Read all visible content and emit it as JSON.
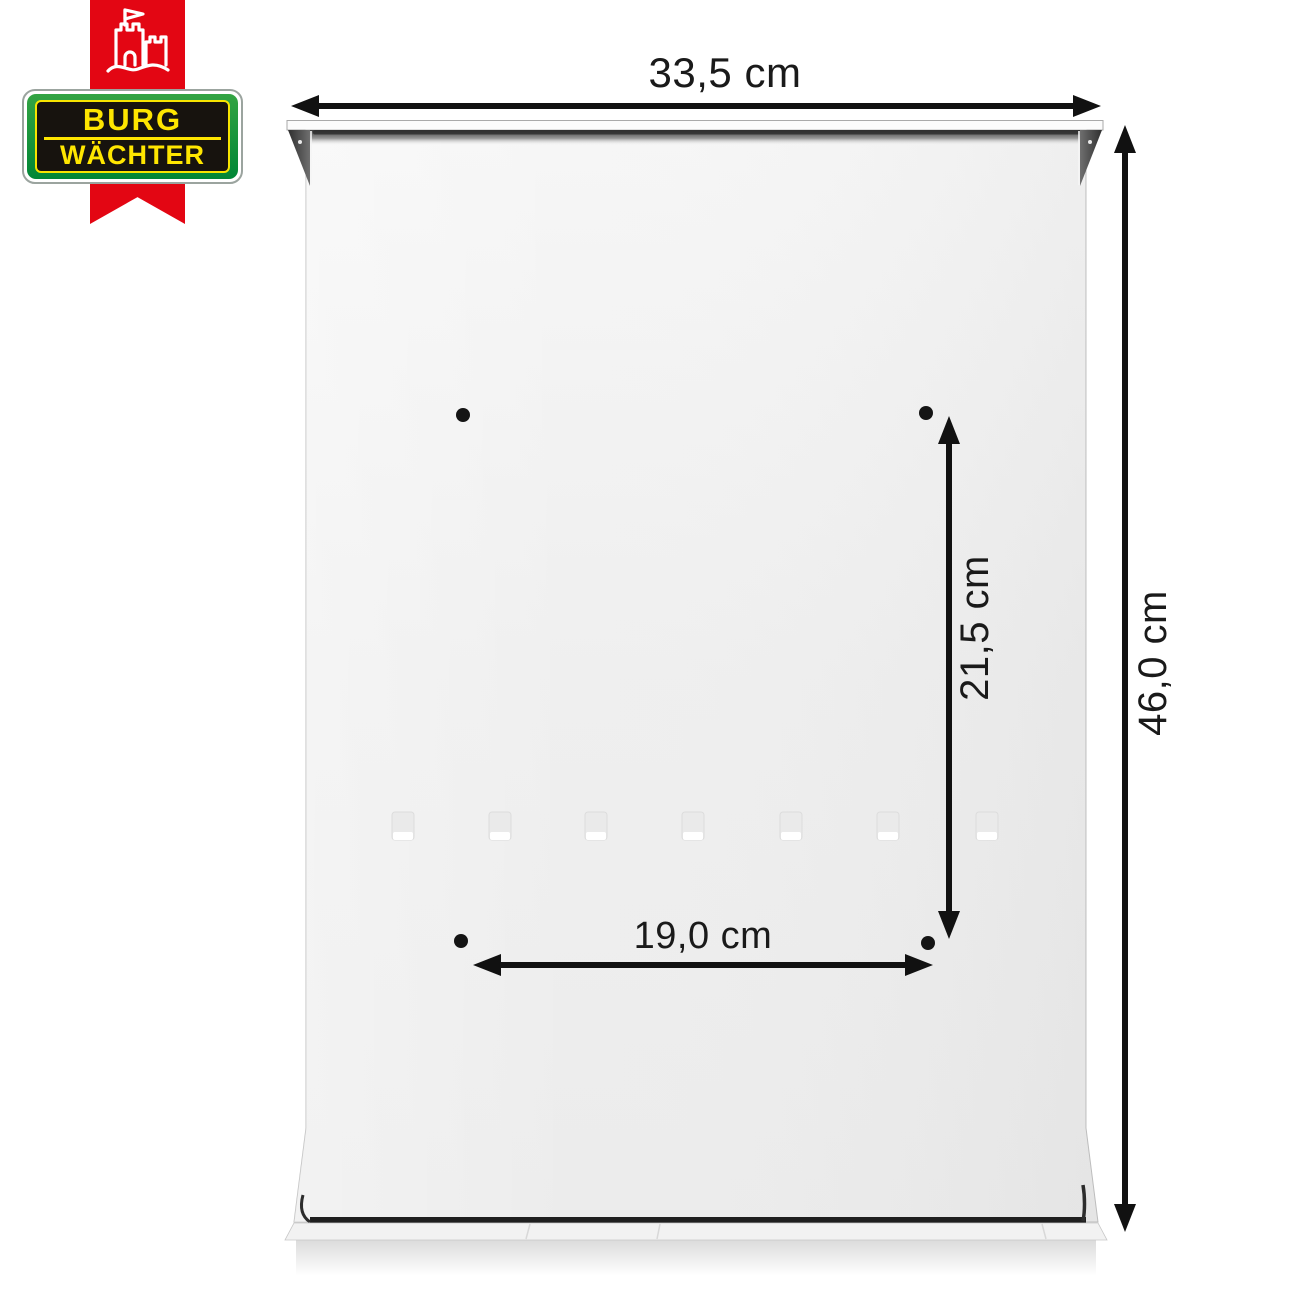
{
  "brand": {
    "line1": "BURG",
    "line2": "WÄCHTER",
    "castle_icon": "castle-with-flag",
    "colors": {
      "ribbon_red": "#e30613",
      "badge_green": "#1b9c3e",
      "badge_yellow": "#ffe600",
      "badge_black": "#17130e"
    }
  },
  "diagram": {
    "type": "product-dimension-diagram",
    "subject": "mailbox back panel with mounting holes",
    "line_color": "#111111",
    "mounting_holes": 4,
    "ventilation_slots": 7,
    "dimensions": {
      "overall_width": "33,5 cm",
      "overall_height": "46,0 cm",
      "hole_spacing_vertical": "21,5 cm",
      "hole_spacing_horizontal": "19,0 cm"
    }
  }
}
